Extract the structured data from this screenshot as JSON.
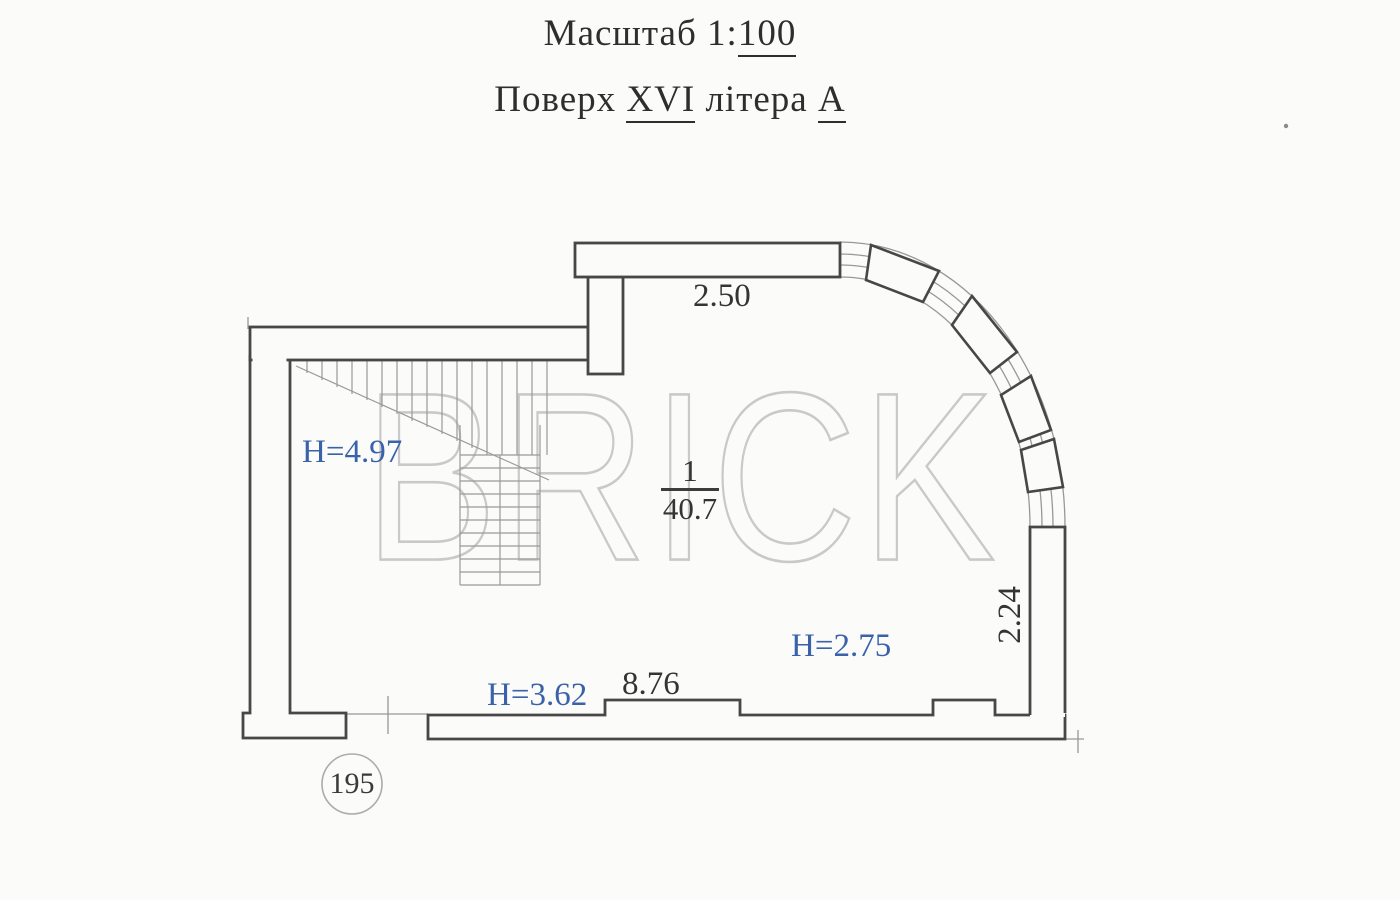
{
  "header": {
    "scale_label": "Масштаб",
    "scale_prefix": "1:",
    "scale_value": "100",
    "floor_label": "Поверх",
    "floor_value": "XVI",
    "letter_label": "літера",
    "letter_value": "А"
  },
  "plan": {
    "dim_top": "2.50",
    "dim_bottom": "8.76",
    "dim_right": "2.24",
    "room_number": "1",
    "room_area": "40.7",
    "height_stairs": "H=4.97",
    "height_left": "H=3.62",
    "height_right": "H=2.75",
    "axis_mark": "195",
    "watermark": "BRICK"
  },
  "colors": {
    "wall_line": "#474747",
    "thin_line": "#989898",
    "height_text": "#3a62ab",
    "dim_text": "#343434",
    "watermark": "#c9c9c9"
  }
}
